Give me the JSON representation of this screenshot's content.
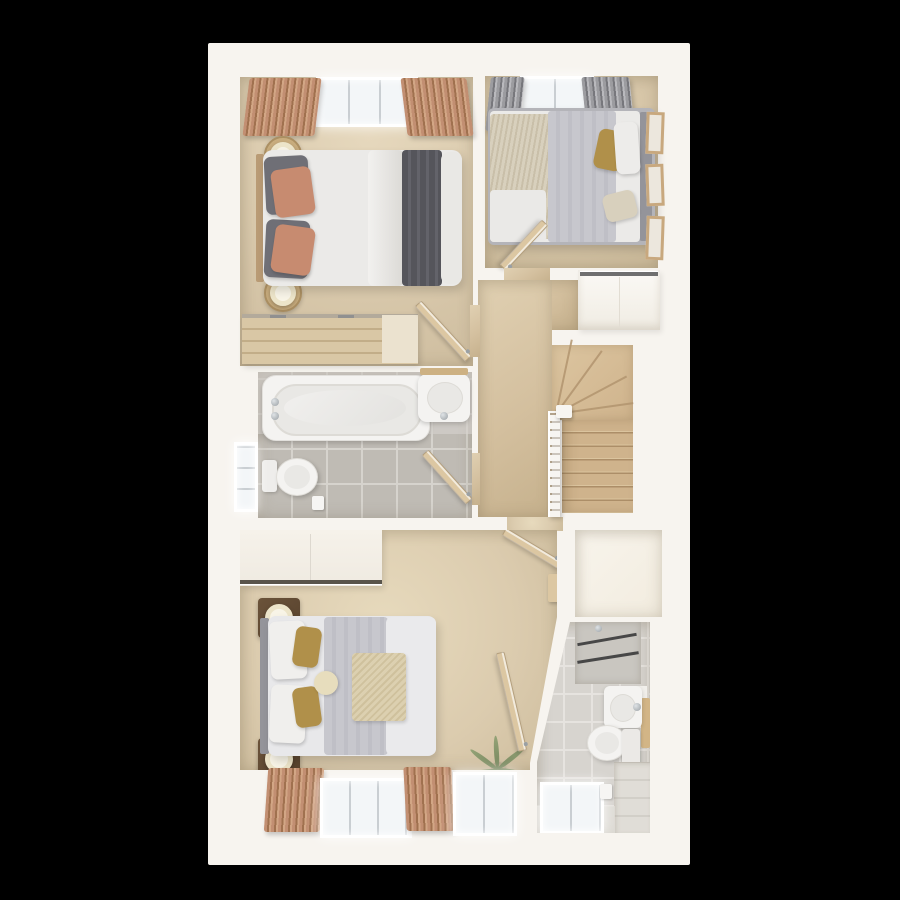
{
  "scene": {
    "description": "Top-down 3D rendered floor plan of a house upper storey on a black background",
    "rooms": [
      "bedroom-1",
      "bedroom-2",
      "landing-stairs",
      "bathroom",
      "master-bedroom",
      "closet",
      "ensuite"
    ]
  },
  "colors": {
    "bg": "#000000",
    "plan-wall": "#f7f4ef",
    "carpet-1": "#d9c9ac",
    "carpet-2": "#d5c4a6",
    "carpet-landing": "#d4c09f",
    "carpet-master": "#dbcbae",
    "floor-closet": "#f2ecdf",
    "stair-tread": "#cfb38c",
    "stair-riser": "#ac8e68",
    "stair-line": "#b2946e",
    "banister": "#f7f5f1",
    "cupboard-face": "#f8f5ef",
    "rail-dark": "#6f6f6f",
    "tile-bath": "#bfbbb4",
    "tile-bath-grout": "#d6d3cd",
    "tile-bath-light": "#d9d6d1",
    "tile-ensuite": "#d7d4cf",
    "tile-ensuite-grout": "#e6e3df",
    "tile-ledge": "#e0ddd7",
    "shower-tile": "#c9c6c0",
    "glass-line": "#474747",
    "white-fixture": "#f4f3f1",
    "fixture-inner": "#e9e8e5",
    "fixture-rim": "#dddbd6",
    "window-glass": "#f3f6f8",
    "window-frame": "#ffffff",
    "mullion": "#c9ced2",
    "curtain-rose": "#c28f72",
    "curtain-rose-dark": "#a0714f",
    "curtain-gray": "#9c9ca0",
    "curtain-gray-dark": "#77777c",
    "door-wood": "#dcc7a2",
    "door-edge": "#f2ebdd",
    "dresser-wood": "#d9c7a5",
    "dresser-slat": "#c2ad88",
    "dresser-light": "#ebe2cf",
    "table-wood": "#c9ad7e",
    "dark-wood": "#57422d",
    "lamp-ring": "#ece4c9",
    "lamp-core": "#f8f4e7",
    "bedding-white": "#ebeae8",
    "duvet-gray": "#c7c7cd",
    "throw-dark": "#55555b",
    "pillow-gray": "#6f6f76",
    "pillow-terracotta": "#c78b70",
    "headboard-gray": "#94949a",
    "headboard-tan": "#b99b75",
    "throw-cream": "#dcd0b0",
    "pillow-gold": "#b0904a",
    "textured-cream": "#d8d0bd",
    "frame-wood": "#c8a87e",
    "frame-inner": "#ece7dd",
    "plant-green": "#75855c",
    "plant-green-light": "#94a377",
    "pot": "#b5a488",
    "chrome": "#9aa0a4",
    "wardrobe-face": "#f6f2ea",
    "wardrobe-rail": "#59544b"
  }
}
